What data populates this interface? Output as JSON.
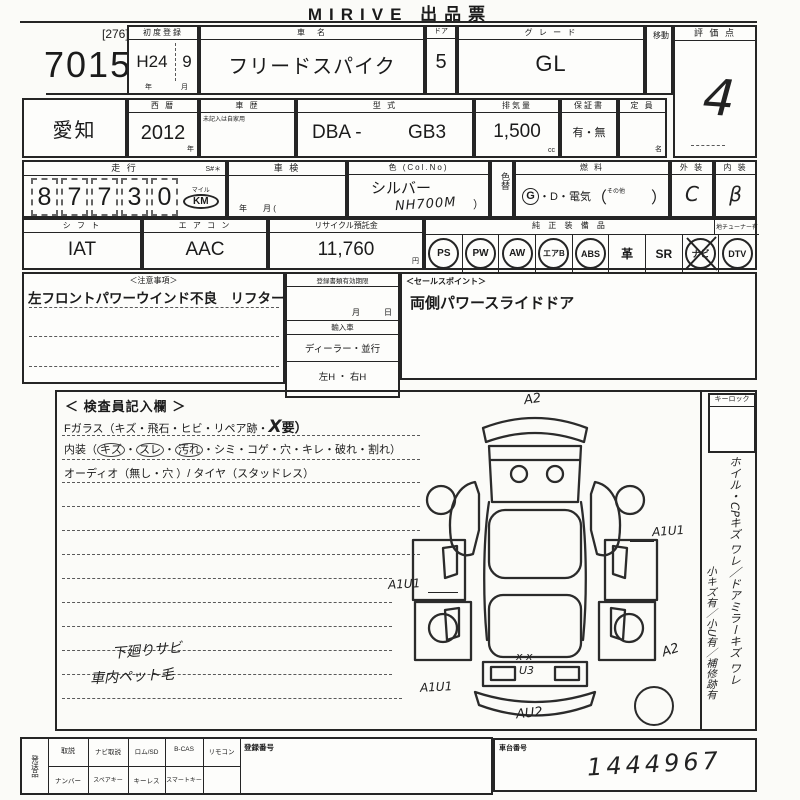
{
  "title": "MIRIVE 出品票",
  "lot": {
    "corner_code": "[276]",
    "number": "70153"
  },
  "header": {
    "first_reg_label": "初度登録",
    "first_reg_era": "H24",
    "first_reg_month": "9",
    "year_char": "年",
    "month_char": "月",
    "car_name_label": "車　名",
    "car_name": "フリードスパイク",
    "door_label": "ドア",
    "door_value": "5",
    "grade_label": "グ レ ー ド",
    "grade_value": "GL",
    "move_label": "移動",
    "score_label": "評 価 点",
    "score_value": "4"
  },
  "registration": {
    "prefecture": "愛知",
    "western_year_label": "西 暦",
    "western_year": "2012",
    "year_suffix": "年",
    "history_label": "車 歴",
    "history_note": "未記入は自家用",
    "model_label": "型 式",
    "model_value": "DBA -",
    "model_code": "GB3",
    "displacement_label": "排気量",
    "displacement_value": "1,500",
    "displacement_unit": "cc",
    "warranty_label": "保証書",
    "warranty_value": "有・無",
    "capacity_label": "定 員",
    "capacity_unit": "名"
  },
  "condition": {
    "mileage_label": "走 行",
    "serial_label": "S#＊",
    "mileage_digits": [
      "8",
      "7",
      "7",
      "3",
      "0"
    ],
    "mileage_unit_top": "マイル",
    "mileage_unit": "KM",
    "inspection_label": "車 検",
    "inspection_bottom": "年　　月 (",
    "color_label": "色 (Col.No)",
    "color_value": "シルバー",
    "color_code": "NH700M",
    "color_paren": "）",
    "color_change_label": "色替",
    "fuel_label": "燃 料",
    "fuel_g": "G",
    "fuel_rest": "・D・電気",
    "fuel_paren_open": "（",
    "fuel_other": "その他",
    "fuel_paren_close": "）",
    "exterior_label": "外 装",
    "exterior_grade": "C",
    "interior_label": "内 装",
    "interior_grade": "β"
  },
  "spec": {
    "shift_label": "シ フ ト",
    "shift_value": "IAT",
    "aircon_label": "エ ア コ ン",
    "aircon_value": "AAC",
    "recycle_label": "リサイクル預託金",
    "recycle_value": "11,760",
    "recycle_unit": "円",
    "equipment_label": "純 正 装 備 品",
    "tuner_label": "地チューナー有",
    "equipment": [
      {
        "label": "PS",
        "circled": true
      },
      {
        "label": "PW",
        "circled": true
      },
      {
        "label": "AW",
        "circled": true
      },
      {
        "label": "エアB",
        "circled": true
      },
      {
        "label": "ABS",
        "circled": true
      },
      {
        "label": "革",
        "circled": false
      },
      {
        "label": "SR",
        "circled": false
      },
      {
        "label": "ナビ",
        "circled": true,
        "crossed": true
      },
      {
        "label": "DTV",
        "circled": true
      }
    ]
  },
  "remarks": {
    "caution_label": "＜注意事項＞",
    "caution_text": "左フロントパワーウインド不良　リフター?",
    "docs_label": "登録書類有効期限",
    "docs_date": "月　　　日",
    "import_label": "輸入車",
    "import_type": "ディーラー・並行",
    "handle_type": "左H ・ 右H",
    "sales_label": "＜セールスポイント＞",
    "sales_text": "両側パワースライドドア"
  },
  "inspection": {
    "panel_title": "＜ 検査員記入欄 ＞",
    "glass_prefix": "Fガラス（キズ・飛石・ヒビ・リペア跡・",
    "glass_mark": "X",
    "glass_suffix": "要）",
    "interior_prefix": "内装（",
    "interior_sep": "・",
    "interior_circled": [
      "キズ",
      "スレ",
      "汚れ"
    ],
    "interior_rest": "・シミ・コゲ・穴・キレ・破れ・割れ）",
    "audio_line": "オーディオ（無し・穴 ）/ タイヤ（スタッドレス）",
    "hand_notes": [
      "下廻りサビ",
      "車内ペット毛"
    ],
    "keylock_label": "キーロック",
    "side_note_1": "ホイル・CPキズ ワレ／ドアミラーキズ ワレ",
    "side_note_2": "小キズ有／小U有／補修跡有",
    "damage_marks": [
      {
        "code": "A2",
        "location": "front-bumper"
      },
      {
        "code": "A1U1",
        "location": "right-front-door"
      },
      {
        "code": "A1U1",
        "location": "left-front-door"
      },
      {
        "code": "A2",
        "location": "right-rear-quarter"
      },
      {
        "code": "x x",
        "location": "rear-gate"
      },
      {
        "code": "U3",
        "location": "rear-gate"
      },
      {
        "code": "A1U1",
        "location": "left-rear-quarter"
      },
      {
        "code": "AU2",
        "location": "rear-bumper"
      }
    ]
  },
  "footer": {
    "shipping_label": "発送品",
    "row1": [
      "取説",
      "ナビ取説",
      "ロム/SD",
      "B-CAS",
      "リモコン"
    ],
    "row2": [
      "ナンバー",
      "スペアキー",
      "キーレス",
      "スマートキー"
    ],
    "reg_number_label": "登録番号",
    "chassis_label": "車台番号",
    "chassis_value": "1444967"
  }
}
